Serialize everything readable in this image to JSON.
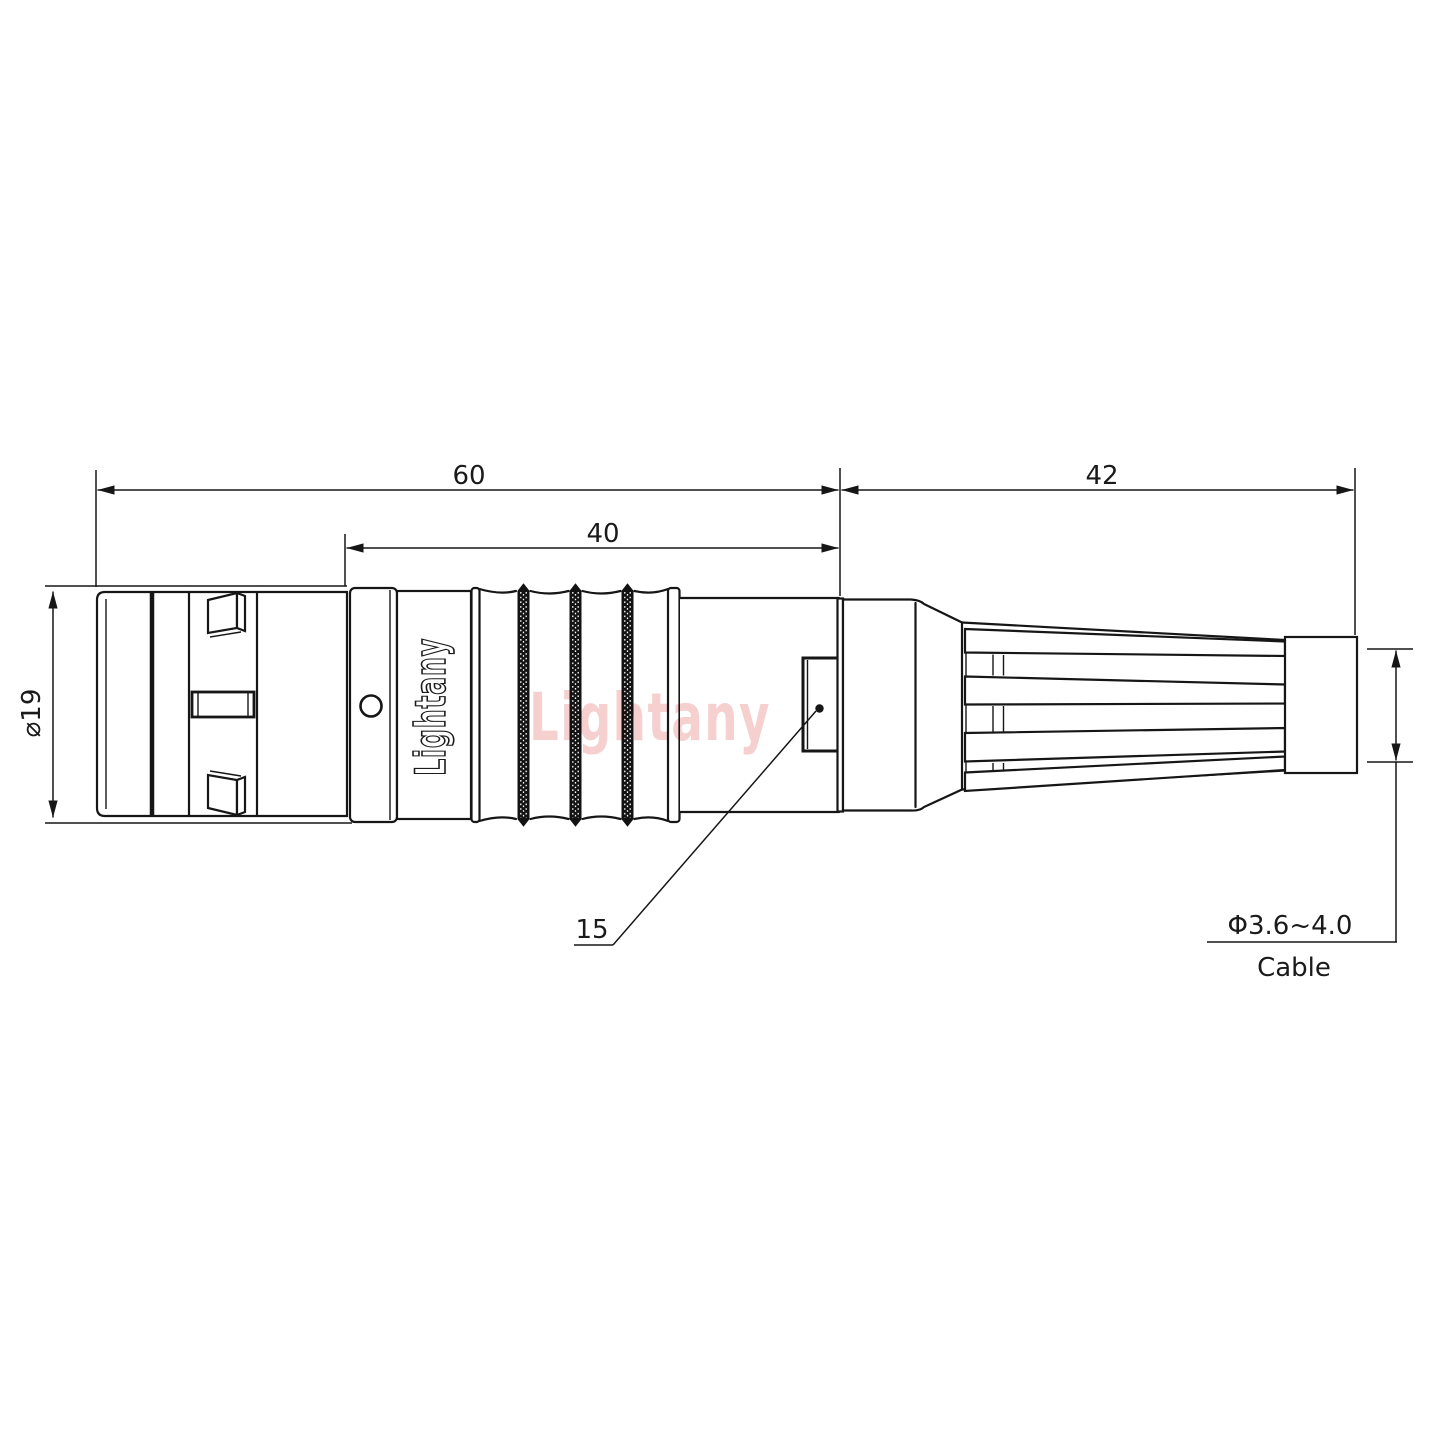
{
  "title": "connector-outline-dimension-drawing",
  "labels": {
    "total_length": "60",
    "rear_length": "42",
    "grip_length": "40",
    "shell_diameter": "⌀19",
    "feature_callout": "15",
    "cable_diameter": "Φ3.6~4.0",
    "cable_word": "Cable"
  },
  "branding": {
    "body_logo_vertical": "Lightany",
    "watermark_center": "Lightany"
  },
  "colors": {
    "line": "#161616",
    "dimension": "#1a1a1a",
    "watermark_pink": "#ee9f9f",
    "background": "#ffffff",
    "knurl_fill": "#121212"
  }
}
